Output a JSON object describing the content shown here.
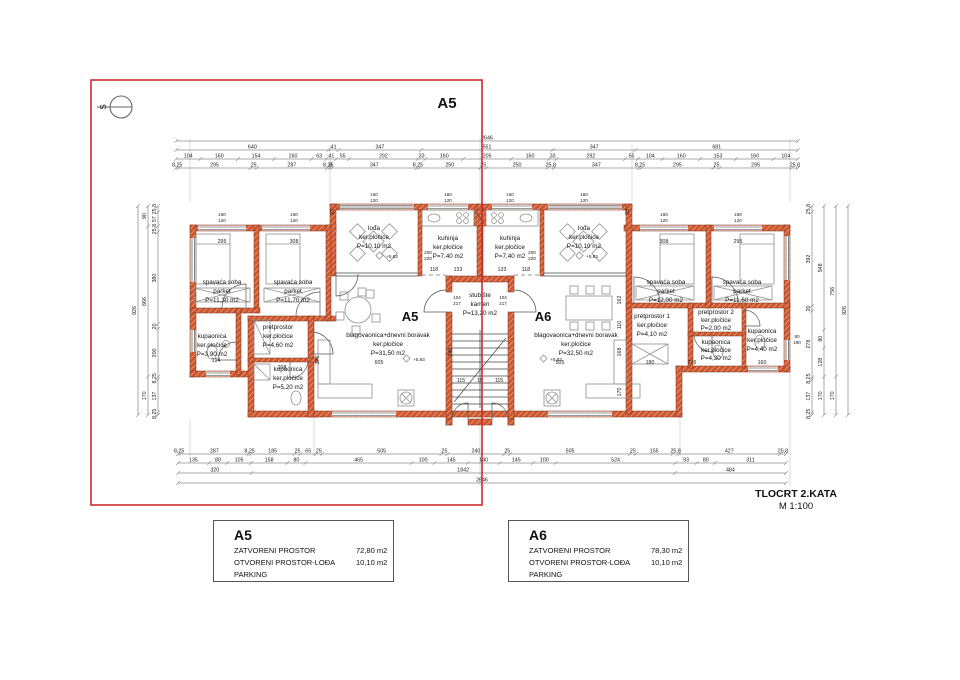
{
  "overlay": {
    "label": "A5"
  },
  "north_label": "S",
  "title": {
    "name": "TLOCRT 2.KATA",
    "scale": "M 1:100"
  },
  "elevation": "+5,83",
  "rooms": {
    "a5_bedroom1": {
      "name": "spavaća soba",
      "floor": "parket",
      "area": "P=11,30 m2"
    },
    "a5_bedroom2": {
      "name": "spavaća soba",
      "floor": "parket",
      "area": "P=11,70 m2"
    },
    "a5_bath1": {
      "name": "kupaonica",
      "floor": "ker.pločice",
      "area": "P=3,90 m2"
    },
    "a5_hall": {
      "name": "pretprostor",
      "floor": "ker.pločice",
      "area": "P=4,60 m2"
    },
    "a5_bath2": {
      "name": "kupaonica",
      "floor": "ker.pločice",
      "area": "P=5,20 m2"
    },
    "a5_loggia": {
      "name": "lođa",
      "floor": "ker.pločice",
      "area": "P=10,10 m2"
    },
    "a5_kitchen": {
      "name": "kuhinja",
      "floor": "ker.pločice",
      "area": "P=7,40 m2"
    },
    "a5_living": {
      "label": "A5",
      "name": "blagovaonica+dnevni boravak",
      "floor": "ker.pločice",
      "area": "P=31,50 m2"
    },
    "stairs": {
      "name": "stubište",
      "floor": "kamen",
      "area": "P=13,20 m2"
    },
    "a6_kitchen": {
      "name": "kuhinja",
      "floor": "ker.pločice",
      "area": "P=7,40 m2"
    },
    "a6_loggia": {
      "name": "lođa",
      "floor": "ker.pločice",
      "area": "P=10,10 m2"
    },
    "a6_bedroom1": {
      "name": "spavaća soba",
      "floor": "parket",
      "area": "P=12,00 m2"
    },
    "a6_bedroom2": {
      "name": "spavaća soba",
      "floor": "parket",
      "area": "P=11,60 m2"
    },
    "a6_hall1": {
      "name": "pretprostor 1",
      "floor": "ker.pločice",
      "area": "P=4,10 m2"
    },
    "a6_hall2": {
      "name": "pretprostor 2",
      "floor": "ker.pločice",
      "area": "P=2,00 m2"
    },
    "a6_bath1": {
      "name": "kupaonica",
      "floor": "ker.pločice",
      "area": "P=4,30 m2"
    },
    "a6_bath2": {
      "name": "kupaonica",
      "floor": "ker.pločice",
      "area": "P=4,40 m2"
    },
    "a6_living": {
      "label": "A6",
      "name": "blagovaonica+dnevni boravak",
      "floor": "ker.pločice",
      "area": "P=32,50 m2"
    }
  },
  "legends": {
    "a5": {
      "id": "A5",
      "rows": [
        {
          "label": "ZATVORENI PROSTOR",
          "value": "72,80 m2"
        },
        {
          "label": "OTVORENI PROSTOR-LOĐA",
          "value": "10,10 m2"
        },
        {
          "label": "PARKING",
          "value": ""
        }
      ]
    },
    "a6": {
      "id": "A6",
      "rows": [
        {
          "label": "ZATVORENI PROSTOR",
          "value": "78,30 m2"
        },
        {
          "label": "OTVORENI PROSTOR-LOĐA",
          "value": "10,10 m2"
        },
        {
          "label": "PARKING",
          "value": ""
        }
      ]
    }
  },
  "dims": {
    "top_total": [
      "2646"
    ],
    "top_row2": [
      "640",
      "41",
      "347",
      "551",
      "347",
      "681"
    ],
    "top_row3": [
      "104",
      "160",
      "154",
      "160",
      "63",
      "41",
      "55",
      "292",
      "33",
      "160",
      "205",
      "160",
      "33",
      "292",
      "55",
      "104",
      "160",
      "153",
      "160",
      "104"
    ],
    "top_row4": [
      "8,25",
      "295",
      "25",
      "287",
      "8,25",
      "8",
      "347",
      "8,25",
      "250",
      "25",
      "250",
      "25,8",
      "347",
      "8,25",
      "295",
      "25",
      "295",
      "25,8"
    ],
    "bottom_row1": [
      "8,25",
      "287",
      "8,25",
      "185",
      "25",
      "65",
      "25",
      "505",
      "25",
      "240",
      "25",
      "505",
      "25",
      "155",
      "25,8",
      "427",
      "25,8"
    ],
    "bottom_row2": [
      "135",
      "80",
      "105",
      "158",
      "80",
      "465",
      "100",
      "145",
      "140",
      "145",
      "100",
      "524",
      "93",
      "80",
      "311"
    ],
    "bottom_row3": [
      "320",
      "1842",
      "484"
    ],
    "bottom_total": [
      "2646"
    ],
    "left_col1": [
      "25,8",
      "57",
      "25,8",
      "380",
      "20",
      "200",
      "8,25",
      "137",
      "8,25"
    ],
    "left_col2": [
      "90",
      "666",
      "170"
    ],
    "left_col3": [
      "926"
    ],
    "right_col1": [
      "25,8",
      "392",
      "20",
      "278",
      "8,25",
      "137",
      "8,25"
    ],
    "right_col2": [
      "548",
      "80",
      "128",
      "170"
    ],
    "right_col3": [
      "756",
      "170"
    ],
    "right_col4": [
      "926"
    ],
    "pairs": {
      "win1": "160",
      "win2": "120",
      "k1": "200",
      "k2": "220",
      "door1": "104",
      "door2": "217",
      "r1": "80",
      "r2": "190"
    },
    "inner": {
      "a": "295",
      "b": "308",
      "c": "118",
      "d": "133",
      "e": "115",
      "f": "15",
      "g": "605",
      "h": "505",
      "i": "370",
      "j": "240",
      "k": "180",
      "l": "160",
      "m": "276",
      "n": "194",
      "o": "208",
      "p": "23",
      "q": "162",
      "r": "110",
      "s": "168",
      "t": "170"
    }
  }
}
